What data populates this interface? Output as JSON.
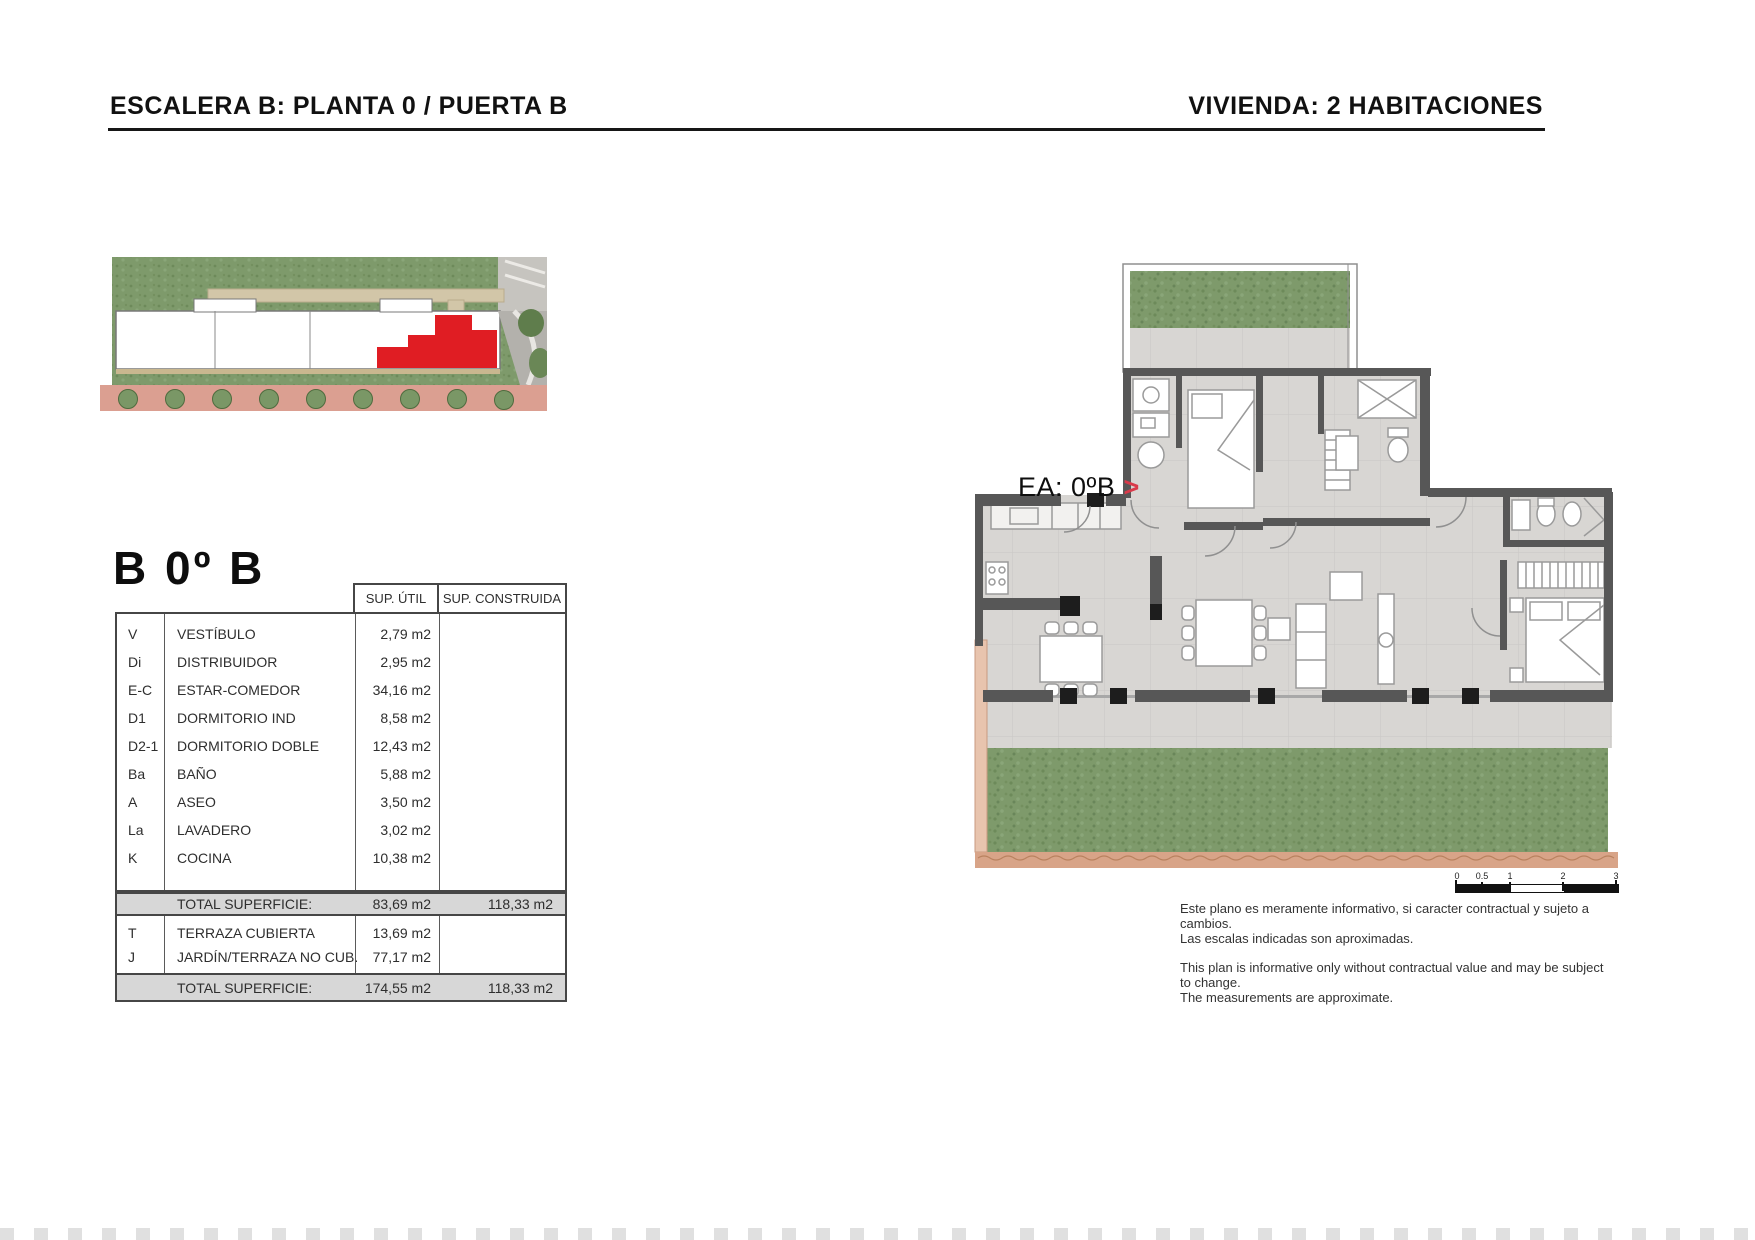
{
  "header": {
    "left_title": "ESCALERA B: PLANTA 0 / PUERTA B",
    "right_title": "VIVIENDA: 2 HABITACIONES"
  },
  "unit": {
    "title": "B 0º B",
    "plan_label": "EA: 0ºB",
    "plan_label_arrow": ">"
  },
  "table": {
    "col_headers": [
      "SUP. ÚTIL",
      "SUP. CONSTRUIDA"
    ],
    "rooms": [
      {
        "code": "V",
        "name": "VESTÍBULO",
        "util": "2,79 m2"
      },
      {
        "code": "Di",
        "name": "DISTRIBUIDOR",
        "util": "2,95 m2"
      },
      {
        "code": "E-C",
        "name": "ESTAR-COMEDOR",
        "util": "34,16 m2"
      },
      {
        "code": "D1",
        "name": "DORMITORIO IND",
        "util": "8,58 m2"
      },
      {
        "code": "D2-1",
        "name": "DORMITORIO DOBLE",
        "util": "12,43 m2"
      },
      {
        "code": "Ba",
        "name": "BAÑO",
        "util": "5,88 m2"
      },
      {
        "code": "A",
        "name": "ASEO",
        "util": "3,50 m2"
      },
      {
        "code": "La",
        "name": "LAVADERO",
        "util": "3,02 m2"
      },
      {
        "code": "K",
        "name": "COCINA",
        "util": "10,38 m2"
      }
    ],
    "total_1": {
      "label": "TOTAL SUPERFICIE:",
      "util": "83,69 m2",
      "construida": "118,33 m2"
    },
    "extras": [
      {
        "code": "T",
        "name": "TERRAZA CUBIERTA",
        "util": "13,69 m2"
      },
      {
        "code": "J",
        "name": "JARDÍN/TERRAZA NO CUB.",
        "util": "77,17 m2"
      }
    ],
    "total_2": {
      "label": "TOTAL SUPERFICIE:",
      "util": "174,55 m2",
      "construida": "118,33 m2"
    }
  },
  "scale_bar": {
    "ticks": [
      "0",
      "0.5",
      "1",
      "2",
      "3"
    ]
  },
  "disclaimer": {
    "es_line1": "Este plano es meramente informativo, si caracter contractual y sujeto a cambios.",
    "es_line2": "Las escalas indicadas son aproximadas.",
    "en_line1": "This plan is informative only without contractual value and may be subject to change.",
    "en_line2": "The measurements are approximate."
  },
  "colors": {
    "highlight_red": "#e01d23",
    "accent_arrow_red": "#d93a4a",
    "wall_gray": "#575757",
    "floor_gray": "#d8d6d3",
    "grass_green": "#7e9a6b",
    "sidewalk_pink": "#db9f91",
    "total_row_gray": "#d7d7d7"
  }
}
